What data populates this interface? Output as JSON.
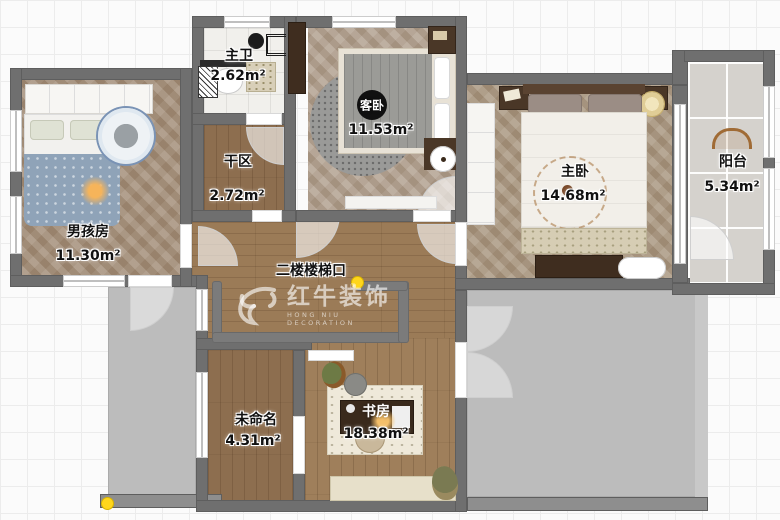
{
  "watermark": {
    "brand": "红牛装饰",
    "subtitle": "HONG NIU DECORATION",
    "registered": "®"
  },
  "rooms": {
    "master_bath": {
      "name": "主卫",
      "area": "2.62m²"
    },
    "dry_area": {
      "name": "干区",
      "area": "2.72m²"
    },
    "guest_bedroom": {
      "name": "客卧",
      "area": "11.53m²"
    },
    "boys_room": {
      "name": "男孩房",
      "area": "11.30m²"
    },
    "master_bedroom": {
      "name": "主卧",
      "area": "14.68m²"
    },
    "balcony": {
      "name": "阳台",
      "area": "5.34m²"
    },
    "stair_landing": {
      "name": "二楼楼梯口"
    },
    "unnamed": {
      "name": "未命名",
      "area": "4.31m²"
    },
    "study": {
      "name": "书房",
      "area": "18.38m²"
    }
  },
  "colors": {
    "wall": "#6f6f6f",
    "void_fill": "#bcbcbc",
    "marker_yellow": "#ffd61c",
    "hall_wood": "#9b7b57",
    "herringbone_wood": "#ab9983",
    "bath_tile": "#f1f0ec",
    "balcony_tile": "#d5d2cd"
  }
}
